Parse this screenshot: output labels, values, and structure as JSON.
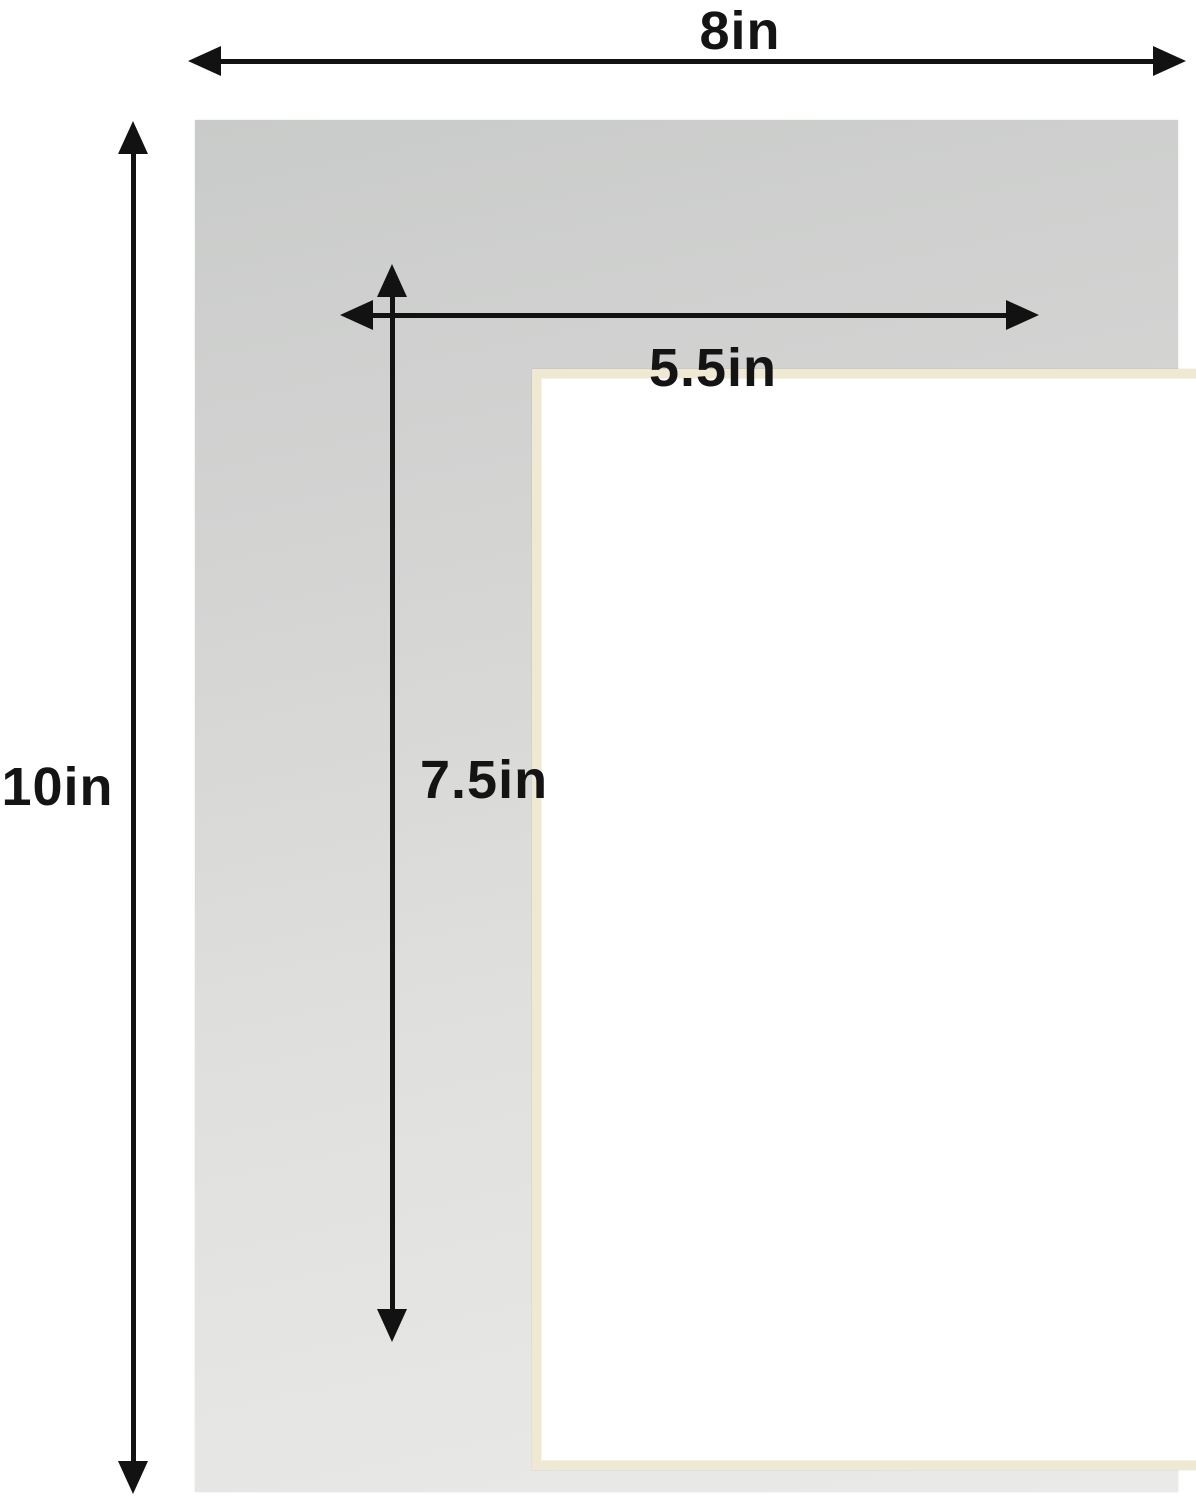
{
  "diagram": {
    "title": "mat-board-dimension-diagram",
    "outer_width": {
      "label": "8in"
    },
    "outer_height": {
      "label": "10in"
    },
    "opening_width": {
      "label": "5.5in"
    },
    "opening_height": {
      "label": "7.5in"
    }
  },
  "colors": {
    "background": "#ffffff",
    "mat_gray_top": "#c9cbca",
    "mat_gray_bottom": "#eaeae8",
    "bevel_cream": "#efe8d3",
    "opening_white": "#ffffff",
    "arrow_black": "#121212",
    "label_black": "#141414"
  }
}
